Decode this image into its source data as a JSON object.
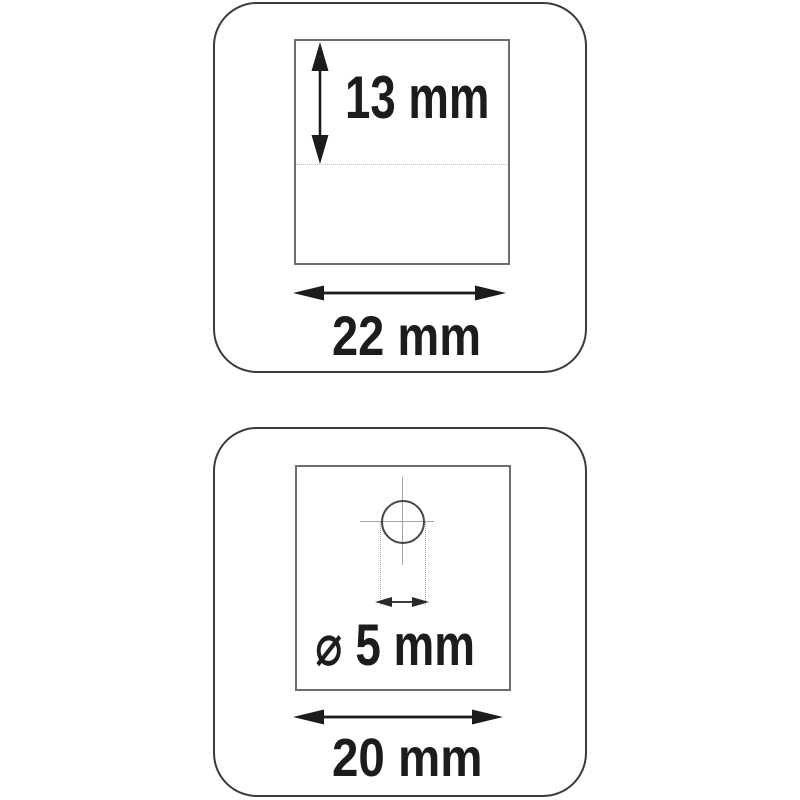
{
  "colors": {
    "background": "#ffffff",
    "line": "#1c1c1c",
    "panel_border": "#3a3a3a",
    "square_border": "#6e6e6e",
    "guide": "#c2c2c2",
    "guide2": "#a6a6a6"
  },
  "top_panel": {
    "height_label": "13 mm",
    "width_label": "22 mm"
  },
  "bottom_panel": {
    "hole_diameter_label": "⌀ 5 mm",
    "width_label": "20 mm"
  }
}
